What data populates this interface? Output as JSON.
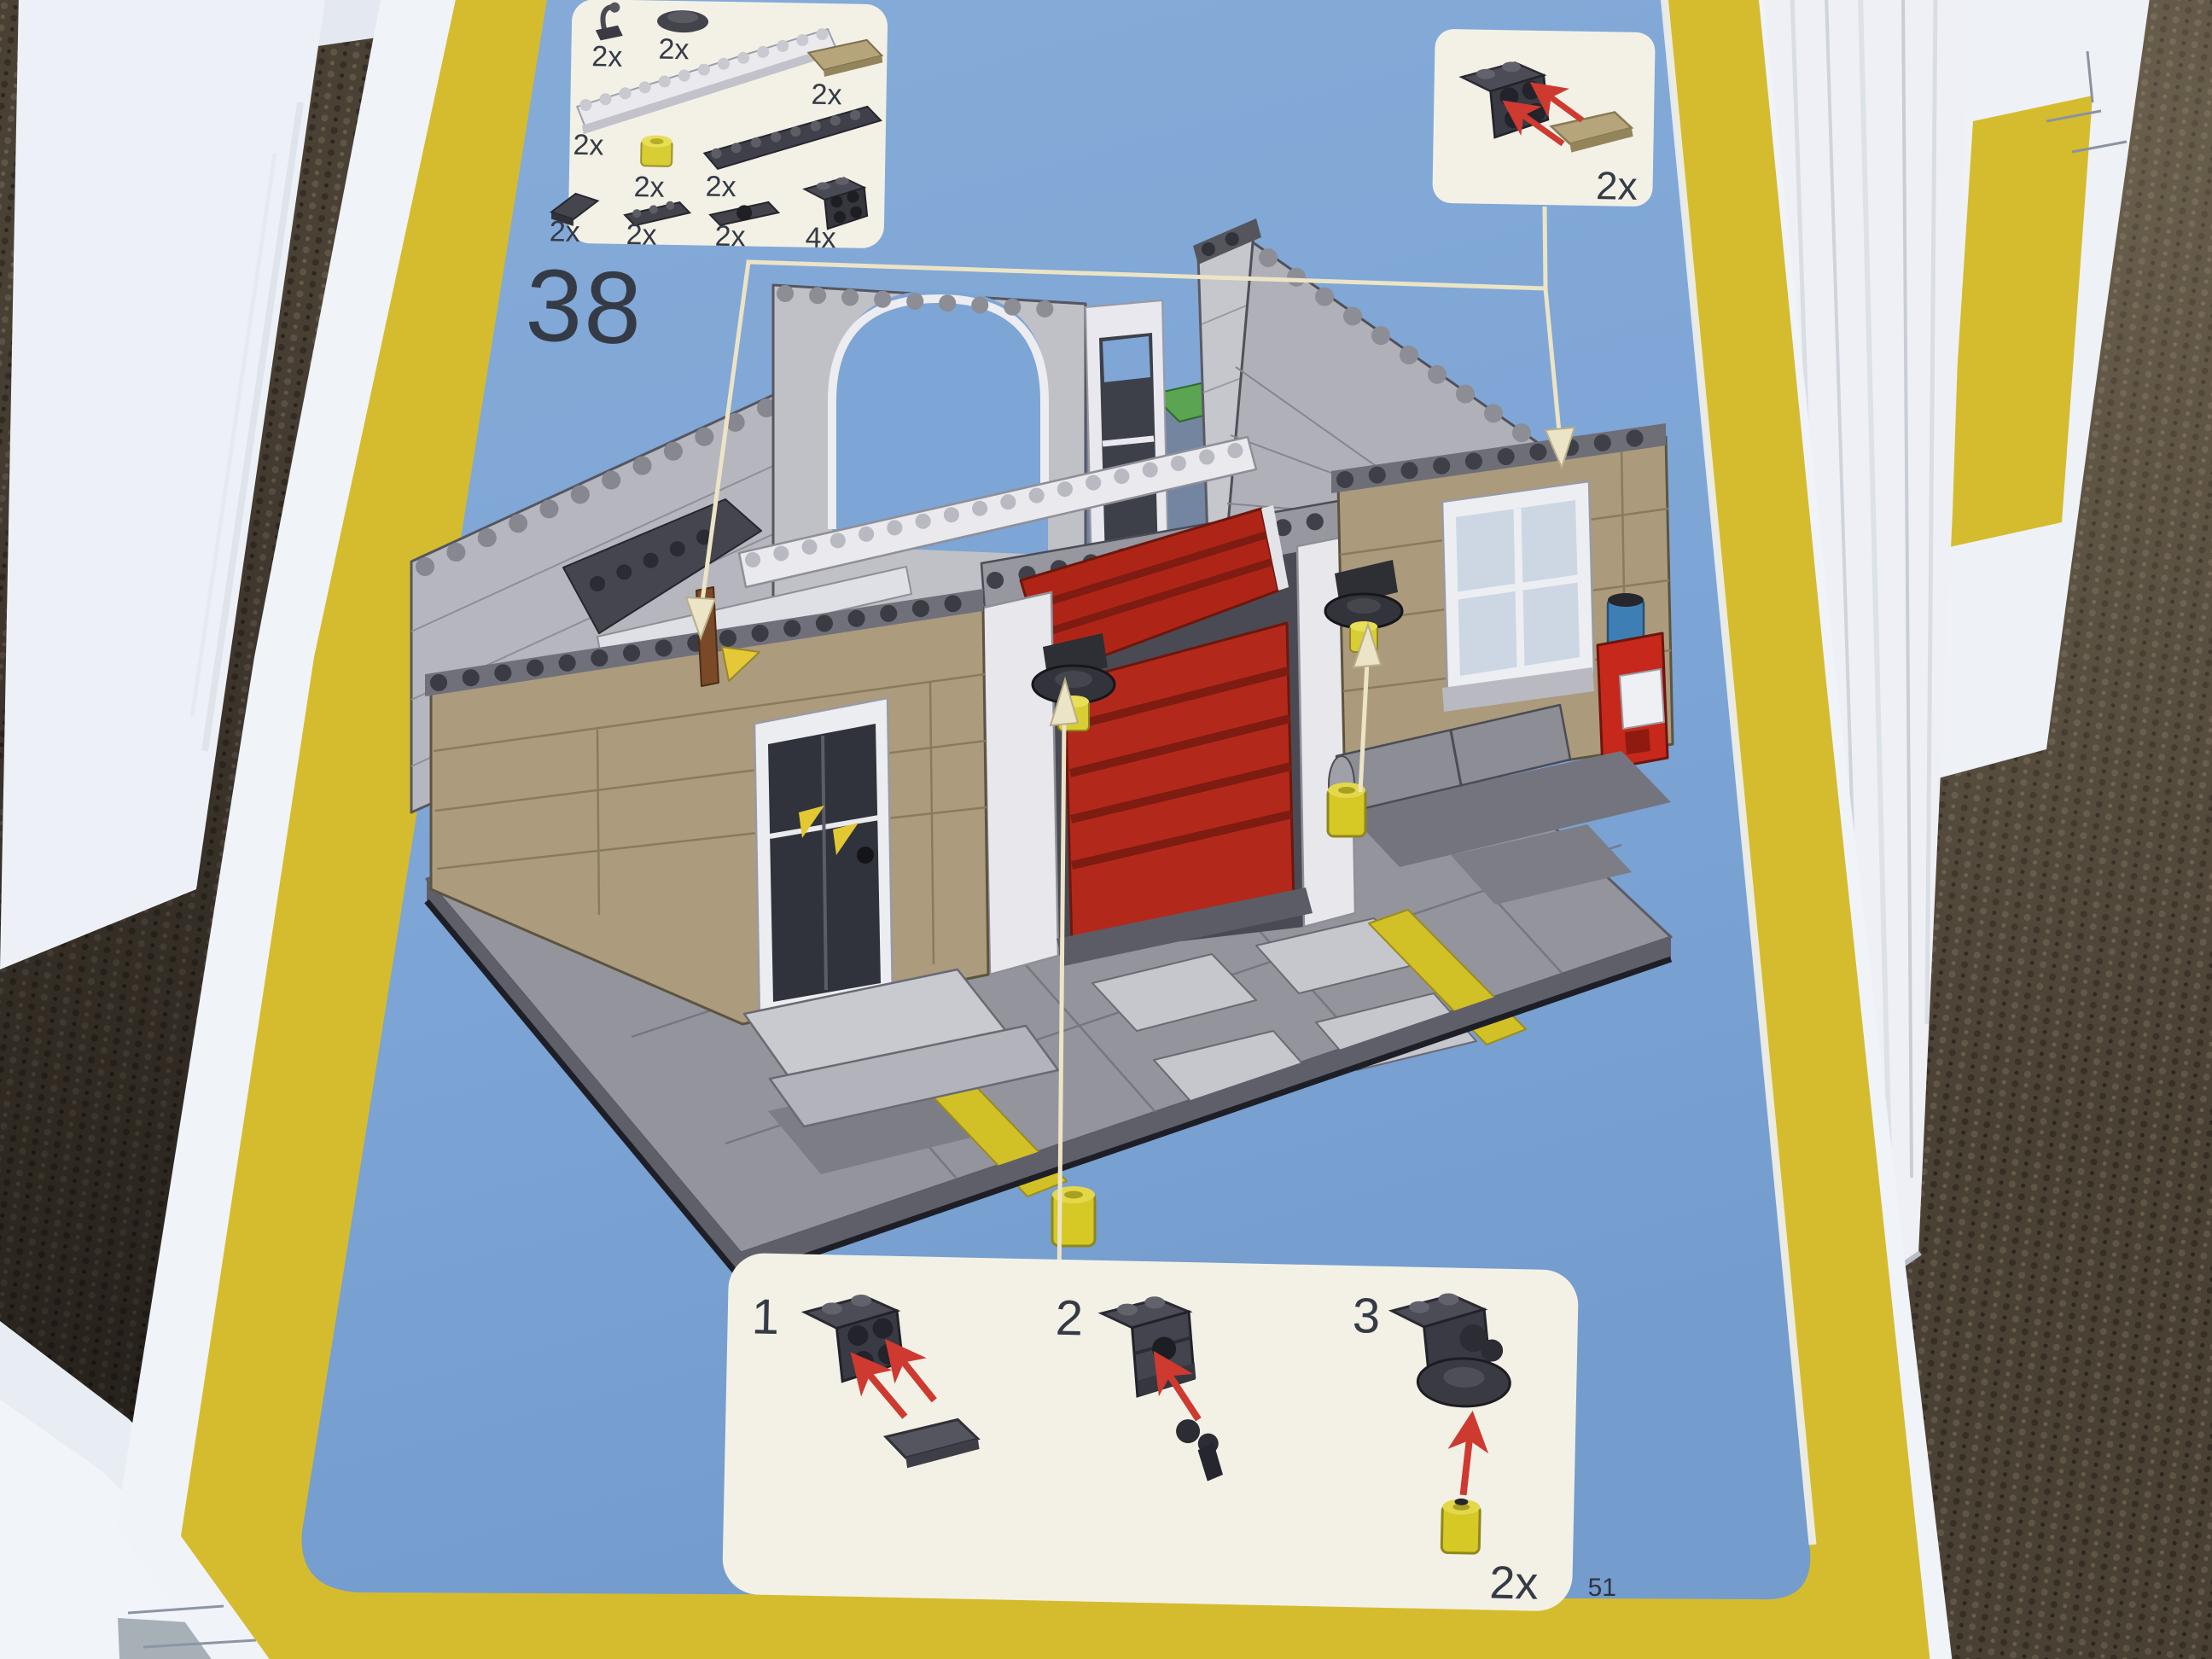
{
  "page": {
    "step_number": "38",
    "page_number": "51"
  },
  "parts_panel": {
    "items": [
      {
        "part": "lever-antenna",
        "qty": "2x"
      },
      {
        "part": "radar-dish",
        "qty": "2x"
      },
      {
        "part": "white-rail-brick",
        "qty": "2x"
      },
      {
        "part": "tan-tile",
        "qty": "2x"
      },
      {
        "part": "trans-yellow-round-brick",
        "qty": "2x"
      },
      {
        "part": "dark-gray-plate-1x8",
        "qty": "2x"
      },
      {
        "part": "dark-gray-slope",
        "qty": "2x"
      },
      {
        "part": "dark-gray-plate-1x3",
        "qty": "2x"
      },
      {
        "part": "dark-gray-plate-with-hole",
        "qty": "2x"
      },
      {
        "part": "dark-gray-bracket-2x2",
        "qty": "4x"
      }
    ]
  },
  "callout_top_right": {
    "qty": "2x"
  },
  "callout_bottom": {
    "steps": [
      {
        "label": "1"
      },
      {
        "label": "2"
      },
      {
        "label": "3"
      }
    ],
    "qty": "2x"
  },
  "colors": {
    "page_blue": "#7da5d5",
    "border_yellow": "#d5bc2e",
    "brick_red": "#b2291b",
    "wall_tan": "#ab9b7c",
    "wall_gray": "#b7b7bf",
    "lamp_yellow": "#d8cd33",
    "arrow_red": "#ce3a30",
    "leader_cream": "#ece4c6",
    "carpet_brown": "#4a4135"
  }
}
